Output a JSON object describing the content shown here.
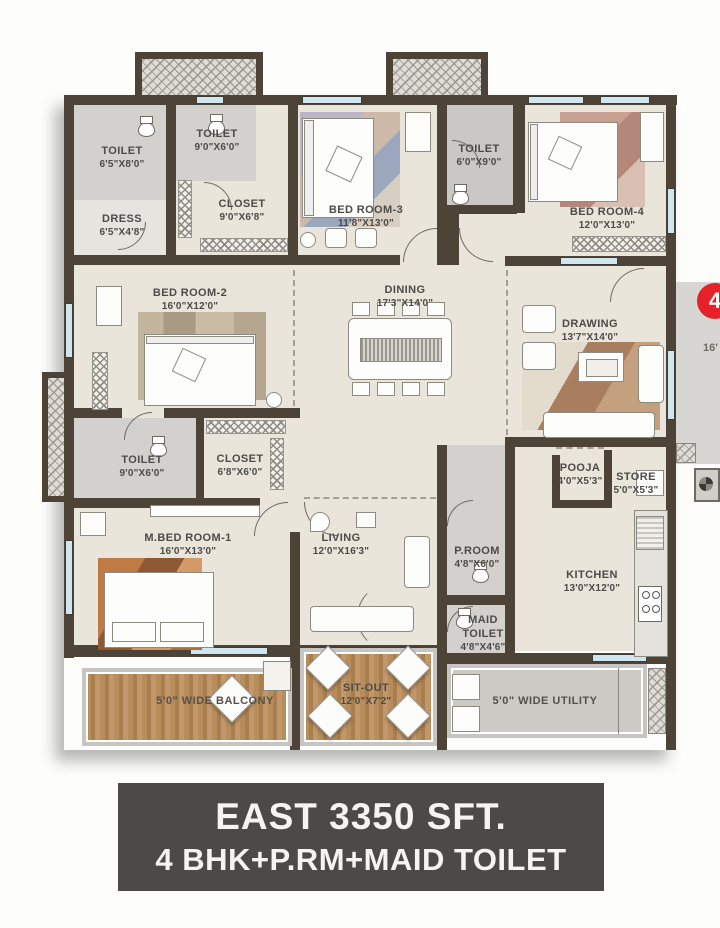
{
  "plan": {
    "rooms": [
      {
        "name": "TOILET",
        "dims": "6'5\"X8'0\""
      },
      {
        "name": "DRESS",
        "dims": "6'5\"X4'8\""
      },
      {
        "name": "TOILET",
        "dims": "9'0\"X6'0\""
      },
      {
        "name": "CLOSET",
        "dims": "9'0\"X6'8\""
      },
      {
        "name": "BED ROOM-3",
        "dims": "11'8\"X13'0\""
      },
      {
        "name": "TOILET",
        "dims": "6'0\"X9'0\""
      },
      {
        "name": "BED ROOM-4",
        "dims": "12'0\"X13'0\""
      },
      {
        "name": "BED ROOM-2",
        "dims": "16'0\"X12'0\""
      },
      {
        "name": "DINING",
        "dims": "17'3\"X14'0\""
      },
      {
        "name": "DRAWING",
        "dims": "13'7\"X14'0\""
      },
      {
        "name": "TOILET",
        "dims": "9'0\"X6'0\""
      },
      {
        "name": "CLOSET",
        "dims": "6'8\"X6'0\""
      },
      {
        "name": "M.BED ROOM-1",
        "dims": "16'0\"X13'0\""
      },
      {
        "name": "LIVING",
        "dims": "12'0\"X16'3\""
      },
      {
        "name": "POOJA",
        "dims": "4'0\"X5'3\""
      },
      {
        "name": "STORE",
        "dims": "5'0\"X5'3\""
      },
      {
        "name": "P.ROOM",
        "dims": "4'8\"X6'0\""
      },
      {
        "name": "KITCHEN",
        "dims": "13'0\"X12'0\""
      },
      {
        "name": "MAID TOILET",
        "dims": "4'8\"X4'6\""
      },
      {
        "name": "SIT-OUT",
        "dims": "12'0\"X7'2\""
      }
    ],
    "balcony_label": "5'0\" WIDE BALCONY",
    "utility_label": "5'0\" WIDE UTILITY",
    "marker": "4",
    "partial_text": "16'"
  },
  "banner": {
    "line1": "EAST 3350 SFT.",
    "line2": "4 BHK+P.RM+MAID TOILET"
  },
  "colors": {
    "wall": "#4e4337",
    "floor": "#eae5da",
    "wet_floor": "#d2d1cd",
    "wood": "#b78d5c",
    "banner_bg": "#4b4a48",
    "marker_red": "#e6212a",
    "window_blue": "#cfe6ee"
  }
}
